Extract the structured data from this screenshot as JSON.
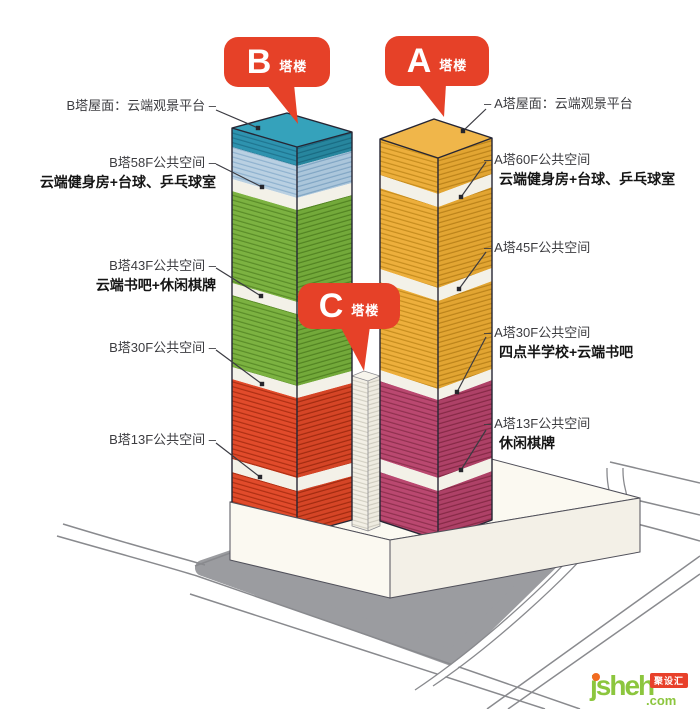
{
  "bubbles": [
    {
      "letter": "B",
      "suffix": "塔楼"
    },
    {
      "letter": "A",
      "suffix": "塔楼"
    },
    {
      "letter": "C",
      "suffix": "塔楼"
    }
  ],
  "left_labels": [
    {
      "text": "B塔屋面：云端观景平台 –"
    },
    {
      "text": "B塔58F公共空间 –"
    },
    {
      "text": "云端健身房+台球、乒乓球室"
    },
    {
      "text": "B塔43F公共空间 –"
    },
    {
      "text": "云端书吧+休闲棋牌"
    },
    {
      "text": "B塔30F公共空间 –"
    },
    {
      "text": "B塔13F公共空间 –"
    }
  ],
  "right_labels": [
    {
      "text": "– A塔屋面：云端观景平台"
    },
    {
      "text": "– A塔60F公共空间"
    },
    {
      "text": "云端健身房+台球、乒乓球室"
    },
    {
      "text": "– A塔45F公共空间"
    },
    {
      "text": "– A塔30F公共空间"
    },
    {
      "text": "四点半学校+云端书吧"
    },
    {
      "text": "– A塔13F公共空间"
    },
    {
      "text": "休闲棋牌"
    }
  ],
  "logo": {
    "name": "jsheh",
    "tld": ".com",
    "badge": "聚设汇"
  },
  "colors": {
    "bubble_red": "#E64128",
    "tower_b_roof_teal": "#2E93AF",
    "tower_b_light_blue": "#B9D0E2",
    "tower_b_green": "#7CB241",
    "tower_b_red": "#E14B2B",
    "tower_a_yellow": "#EDAF3C",
    "tower_a_magenta": "#BA4870",
    "band_white": "#F3F1E8",
    "plaza_gray": "#9B9CA0",
    "logo_green": "#8CC63E"
  }
}
